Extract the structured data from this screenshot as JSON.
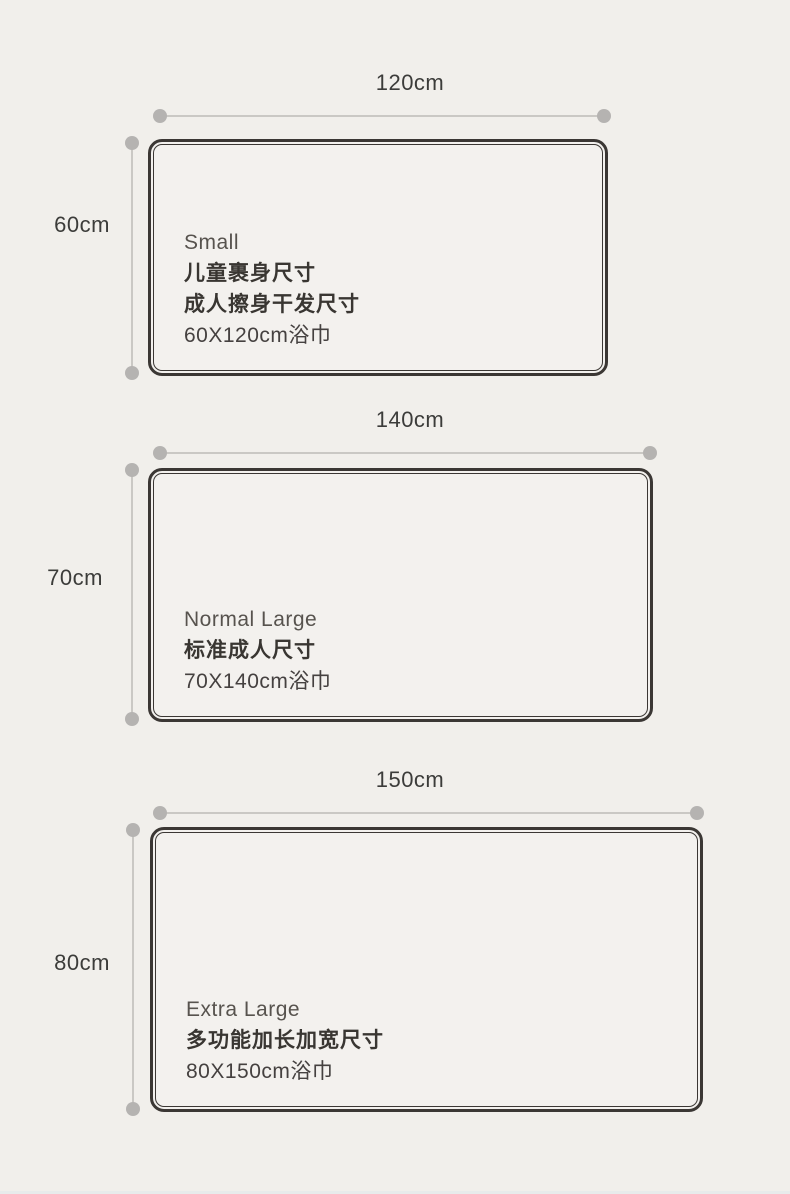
{
  "page": {
    "background_color": "#f1efeb",
    "rect_fill_color": "#f3f1ee",
    "rect_border_color": "#3b3734",
    "dimension_line_color": "#cac8c4",
    "dimension_dot_color": "#b5b3b1",
    "bottom_strip_color": "#e8ebeb"
  },
  "sections": [
    {
      "width_label": "120cm",
      "height_label": "60cm",
      "name_en": "Small",
      "desc_line1": "儿童裹身尺寸",
      "desc_line2": "成人擦身干发尺寸",
      "size_label": "60X120cm浴巾"
    },
    {
      "width_label": "140cm",
      "height_label": "70cm",
      "name_en": "Normal Large",
      "desc_line1": "标准成人尺寸",
      "size_label": "70X140cm浴巾"
    },
    {
      "width_label": "150cm",
      "height_label": "80cm",
      "name_en": "Extra Large",
      "desc_line1": "多功能加长加宽尺寸",
      "size_label": "80X150cm浴巾"
    }
  ]
}
